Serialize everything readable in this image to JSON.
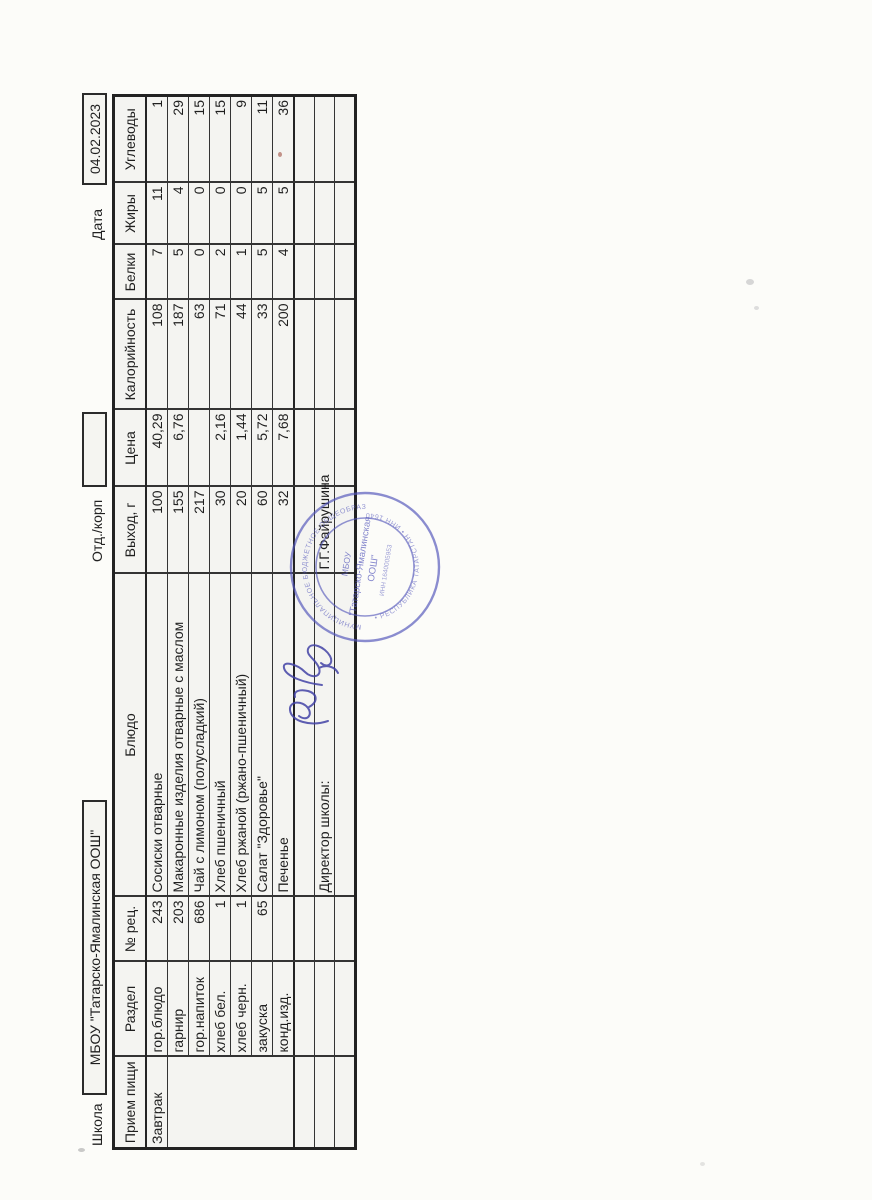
{
  "header_line": {
    "school_label": "Школа",
    "school_name": "МБОУ \"Татарско-Ямалинская ООШ\"",
    "dept_label": "Отд./корп",
    "dept_value": "",
    "date_label": "Дата",
    "date_value": "04.02.2023"
  },
  "table": {
    "columns": [
      "Прием пищи",
      "Раздел",
      "№ рец.",
      "Блюдо",
      "Выход, г",
      "Цена",
      "Калорийность",
      "Белки",
      "Жиры",
      "Углеводы"
    ],
    "meal": "Завтрак",
    "rows": [
      {
        "razdel": "гор.блюдо",
        "rec": "243",
        "dish": "Сосиски отварные",
        "out": "100",
        "price": "40,29",
        "kcal": "108",
        "protein": "7",
        "fat": "11",
        "carbs": "1"
      },
      {
        "razdel": "гарнир",
        "rec": "203",
        "dish": "Макаронные изделия отварные с маслом",
        "out": "155",
        "price": "6,76",
        "kcal": "187",
        "protein": "5",
        "fat": "4",
        "carbs": "29"
      },
      {
        "razdel": "гор.напиток",
        "rec": "686",
        "dish": "Чай с лимоном (полусладкий)",
        "out": "217",
        "price": "",
        "kcal": "63",
        "protein": "0",
        "fat": "0",
        "carbs": "15"
      },
      {
        "razdel": "хлеб бел.",
        "rec": "1",
        "dish": "Хлеб пшеничный",
        "out": "30",
        "price": "2,16",
        "kcal": "71",
        "protein": "2",
        "fat": "0",
        "carbs": "15"
      },
      {
        "razdel": "хлеб черн.",
        "rec": "1",
        "dish": "Хлеб ржаной (ржано-пшеничный)",
        "out": "20",
        "price": "1,44",
        "kcal": "44",
        "protein": "1",
        "fat": "0",
        "carbs": "9"
      },
      {
        "razdel": "закуска",
        "rec": "65",
        "dish": "Салат \"Здоровье\"",
        "out": "60",
        "price": "5,72",
        "kcal": "33",
        "protein": "5",
        "fat": "5",
        "carbs": "11"
      },
      {
        "razdel": "конд.изд.",
        "rec": "",
        "dish": "Печенье",
        "out": "32",
        "price": "7,68",
        "kcal": "200",
        "protein": "4",
        "fat": "5",
        "carbs": "36"
      }
    ],
    "footer": {
      "director_label": "Директор школы:",
      "director_name": "Г.Г.Файрушина"
    }
  },
  "stamp": {
    "ring_text_top": "МУНИЦИПАЛЬНОЕ БЮДЖЕТНОЕ ОБЩЕОБРАЗОВАТЕЛЬНОЕ УЧРЕЖДЕНИЕ",
    "ring_text_bottom": "• РЕСПУБЛИКА ТАТАРСТАН • ИНН 1640005953 •",
    "center_line1": "МБОУ",
    "center_line2": "\"Татарско-Ямалинская",
    "center_line3": "ООШ\"",
    "center_line4": "ИНН 1640005953"
  },
  "colors": {
    "ink": "#1f1f1f",
    "grid": "#343434",
    "stamp_blue": "#5457bb",
    "signature_blue": "#4343a6",
    "paper": "#fcfcf9",
    "cell_fill": "#f4f4f1"
  }
}
